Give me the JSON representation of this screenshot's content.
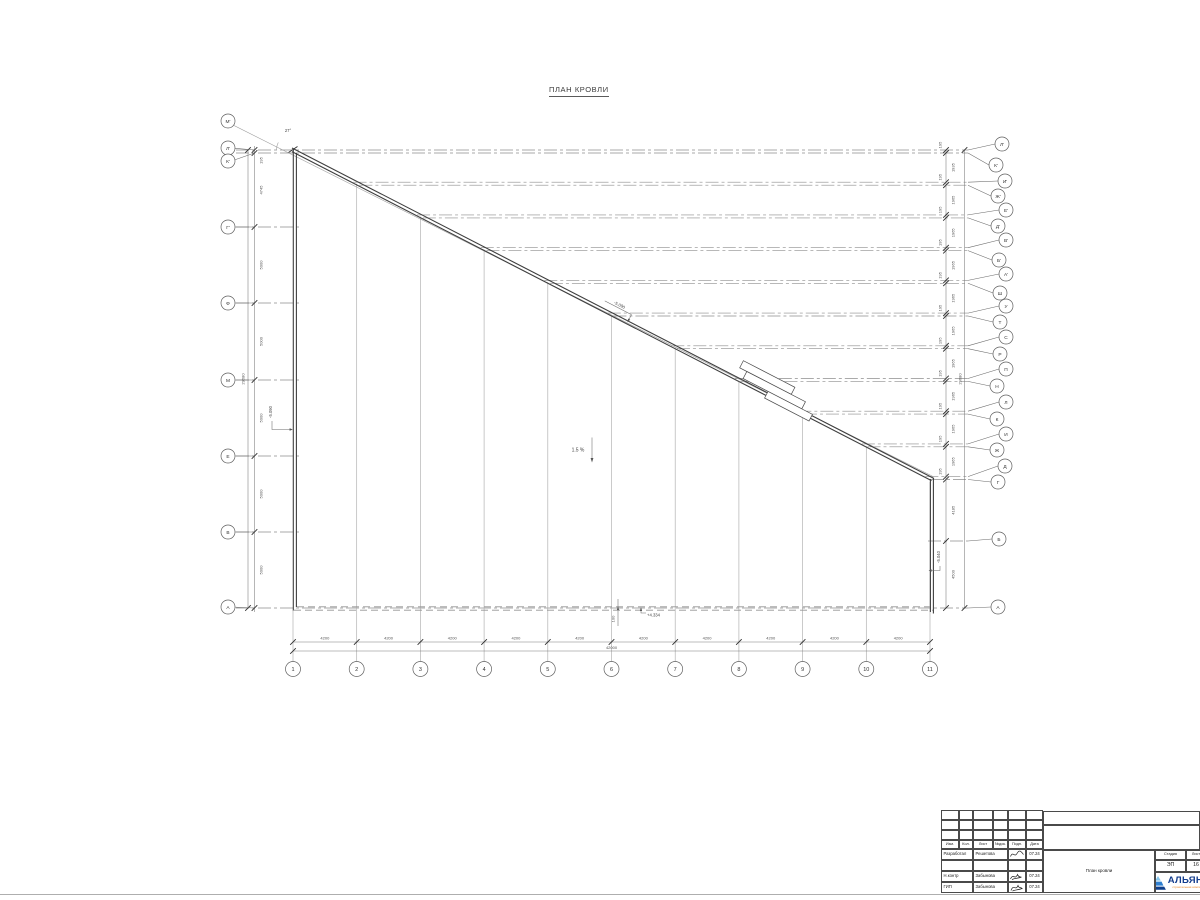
{
  "title": "ПЛАН КРОВЛИ",
  "annotations": {
    "angle": "27°",
    "slope": "1.5 %",
    "elev_slope": "-5.090",
    "elev_left": "-5.090",
    "elev_right": "-5.040",
    "elev_eaves": "+4.334",
    "parapet_offset": "100"
  },
  "grid": {
    "bottom": {
      "labels": [
        "1",
        "2",
        "3",
        "4",
        "5",
        "6",
        "7",
        "8",
        "9",
        "10",
        "11"
      ],
      "bay": "4200",
      "total": "42000"
    },
    "left": {
      "labels": [
        "М'",
        "Л'",
        "К'",
        "Г'",
        "Ф",
        "М",
        "Е",
        "В",
        "А"
      ],
      "dims": [
        "195",
        "4745",
        "5000",
        "5000",
        "5000",
        "5000",
        "5000"
      ],
      "total": "29680"
    },
    "right": {
      "labels": [
        "Л'",
        "К'",
        "И'",
        "Ж'",
        "Е'",
        "Д'",
        "В'",
        "Б'",
        "А'",
        "Ш",
        "У",
        "Т",
        "С",
        "Р",
        "П",
        "Н",
        "Л",
        "К",
        "И",
        "Ж",
        "Д",
        "Г",
        "Б",
        "А"
      ],
      "dims": [
        "195",
        "1935",
        "195",
        "1965",
        "195",
        "1965",
        "195",
        "1965",
        "195",
        "1965",
        "195",
        "1965",
        "195",
        "1965",
        "195",
        "1965",
        "195",
        "1965",
        "195",
        "1965",
        "195",
        "4185",
        "4500"
      ],
      "total": "29680"
    }
  },
  "title_block": {
    "rev_headers": [
      "Изм.",
      "Кол.",
      "Лист",
      "№док.",
      "Подп.",
      "Дата"
    ],
    "staff": [
      {
        "role": "Разработал",
        "name": "Решетова",
        "date": "07.24"
      },
      {
        "role": "Н.контр",
        "name": "Забынова",
        "date": "07.24"
      },
      {
        "role": "ГИП",
        "name": "Забынова",
        "date": "07.24"
      }
    ],
    "stage_label": "Стадия",
    "sheet_label": "Лист",
    "stage": "ЭП",
    "sheet": "16",
    "doc_title": "План кровли",
    "logo": {
      "text": "АЛЬЯНС",
      "tagline": "строительная компания",
      "colors": {
        "light": "#86c6ec",
        "mid": "#2e7fd0",
        "dark": "#0d3e8c",
        "text": "#143d8d",
        "tagline": "#e8821e"
      }
    }
  }
}
